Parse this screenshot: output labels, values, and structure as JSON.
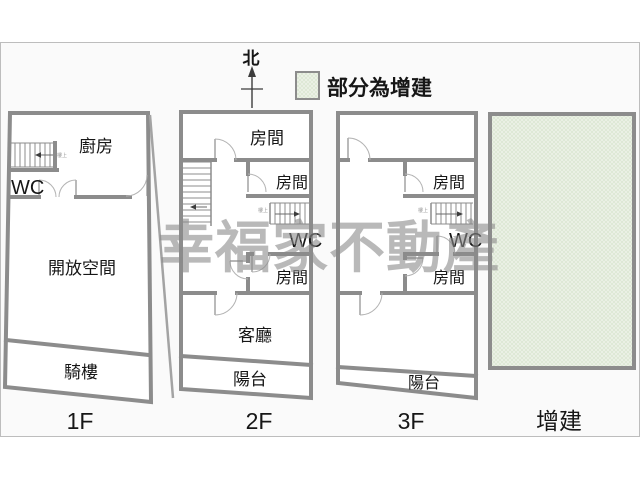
{
  "compass": {
    "label": "北"
  },
  "legend": {
    "label": "部分為增建"
  },
  "watermark": {
    "text": "幸福家不動產"
  },
  "floor1": {
    "label": "1F",
    "kitchen": "廚房",
    "wc": "WC",
    "open_space": "開放空間",
    "arcade": "騎樓",
    "stair_note": "樓上"
  },
  "floor2": {
    "label": "2F",
    "room_top": "房間",
    "room_mid": "房間",
    "wc": "WC",
    "room_bottom": "房間",
    "living_room": "客廳",
    "balcony": "陽台",
    "stair_note": "樓上"
  },
  "floor3": {
    "label": "3F",
    "room_mid": "房間",
    "wc": "WC",
    "room_bottom": "房間",
    "balcony": "陽台",
    "stair_note": "樓上"
  },
  "extension": {
    "label": "增建"
  },
  "colors": {
    "panel_bg": "#fafafa",
    "panel_border": "#bdbdbd",
    "wall": "#8c8c8c",
    "addition_fill": "#eef2e9",
    "addition_hatch": "#dbe7d2",
    "watermark": "#8a8a8a"
  }
}
